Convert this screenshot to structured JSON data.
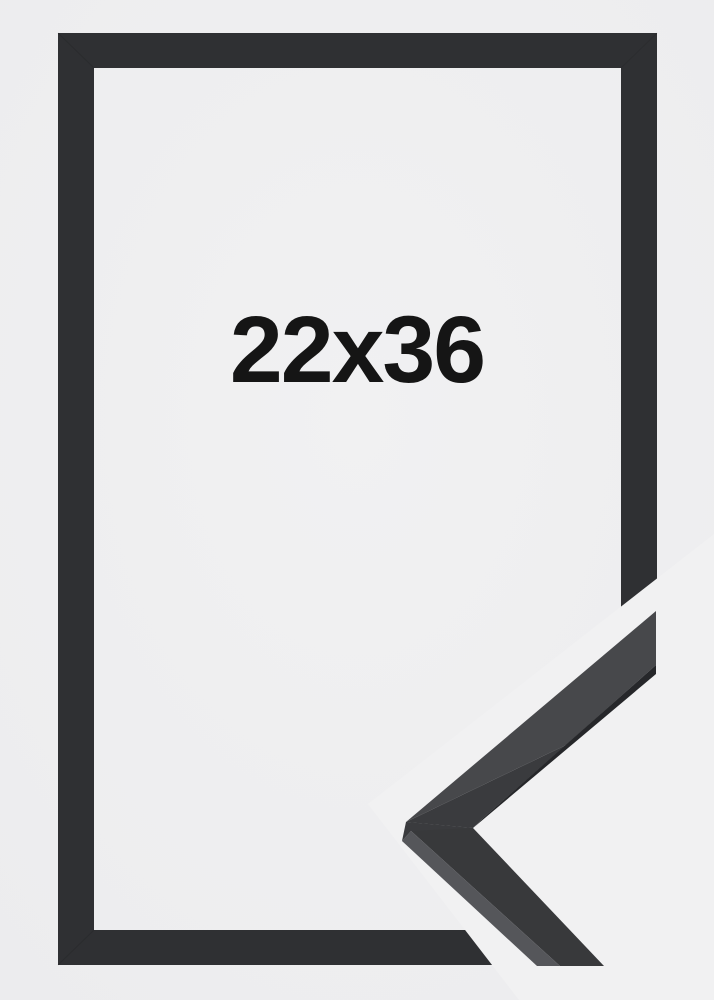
{
  "product": {
    "size_label": "22x36"
  },
  "colors": {
    "background": "#f1f1f2",
    "background_edge": "#ececee",
    "frame": "#2f3033",
    "frame_miter_line": "#1c1d1f",
    "label_text": "#151515",
    "detail_top_face": "#47484b",
    "detail_front_face": "#3a3b3e",
    "detail_inner_lip": "#26272a",
    "detail_lower_face": "#38393b",
    "detail_outer_edge": "#55565a"
  }
}
